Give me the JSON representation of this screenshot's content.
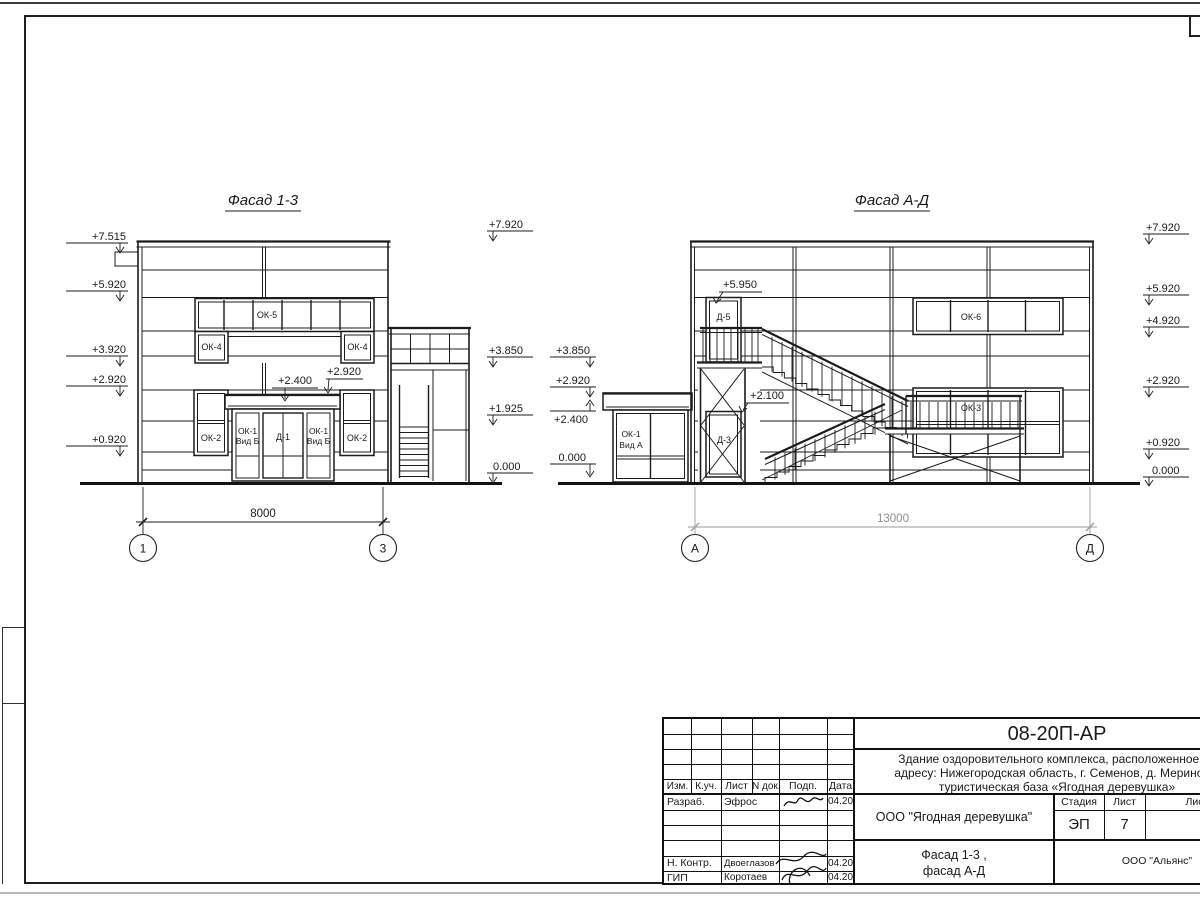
{
  "facade13": {
    "title": "Фасад 1-3",
    "elev_left": [
      "+7.515",
      "+5.920",
      "+3.920",
      "+2.920",
      "+0.920"
    ],
    "elev_right": [
      "+7.920",
      "+3.850",
      "+1.925",
      "0.000"
    ],
    "ann_canopy": "+2.400",
    "ann_canopy2": "+2.920",
    "win": {
      "ok5": "ОК-5",
      "ok4_left": "ОК-4",
      "ok4_right": "ОК-4",
      "ok2_left": "ОК-2",
      "ok2_right": "ОК-2",
      "ok1_left_l1": "ОК-1",
      "ok1_left_l2": "Вид Б",
      "d1": "Д-1",
      "ok1_right_l1": "ОК-1",
      "ok1_right_l2": "Вид Б"
    },
    "dim": "8000",
    "axis_left": "1",
    "axis_right": "3"
  },
  "facadeAD": {
    "title": "Фасад А-Д",
    "elev_left": [
      "+3.850",
      "+2.920",
      "+2.400",
      "0.000"
    ],
    "elev_right": [
      "+7.920",
      "+5.920",
      "+4.920",
      "+2.920",
      "+0.920",
      "0.000"
    ],
    "ann_d5": "+5.950",
    "ann_d3": "+2.100",
    "win": {
      "d5": "Д-5",
      "d3": "Д-3",
      "ok6": "ОК-6",
      "ok3": "ОК-3",
      "ok1_l1": "ОК-1",
      "ok1_l2": "Вид А"
    },
    "dim": "13000",
    "axis_left": "А",
    "axis_right": "Д"
  },
  "titleblock": {
    "code": "08-20П-АР",
    "desc_line1": "Здание оздоровительного комплекса, расположенное по",
    "desc_line2": "адресу: Нижегородская область, г. Семенов, д. Мериново,",
    "desc_line3": "туристическая база «Ягодная деревушка»",
    "col_izm": "Изм.",
    "col_kuch": "К.уч.",
    "col_list": "Лист",
    "col_ndok": "N док.",
    "col_podp": "Подп.",
    "col_data": "Дата",
    "row1_role": "Разраб.",
    "row1_name": "Эфрос",
    "row1_date": "04.20",
    "row2_role": "Н. Контр.",
    "row2_name": "Двоеглазов",
    "row2_date": "04.20",
    "row3_role": "ГИП",
    "row3_name": "Коротаев",
    "row3_date": "04.20",
    "org": "ООО \"Ягодная деревушка\"",
    "stage_label": "Стадия",
    "sheet_label": "Лист",
    "sheets_label": "Листов",
    "stage": "ЭП",
    "sheet_num": "7",
    "drawing_name1": "Фасад 1-3 ,",
    "drawing_name2": "фасад А-Д",
    "company": "ООО \"Альянс\""
  }
}
